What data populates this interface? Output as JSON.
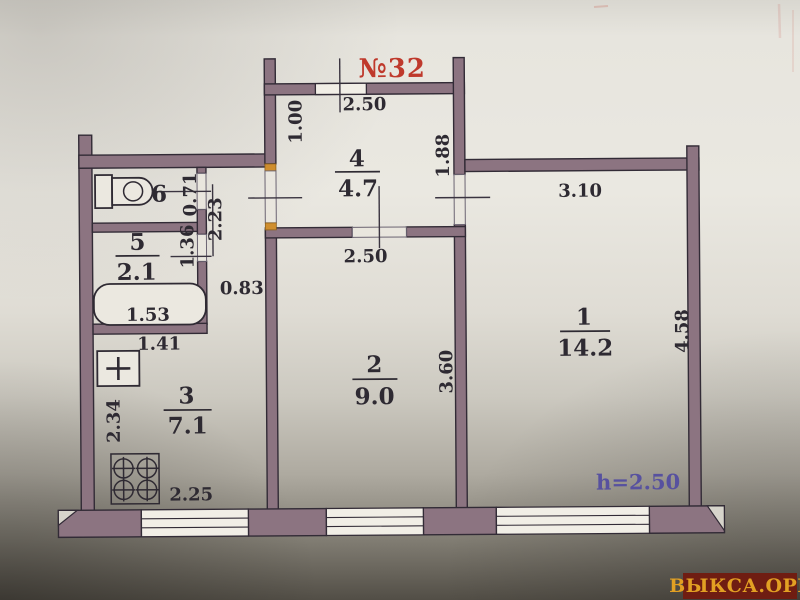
{
  "title": {
    "apartment_no": "№32"
  },
  "note": {
    "ceiling_height": "h=2.50"
  },
  "watermark": {
    "text": "ВЫКСА.ОРГ"
  },
  "rooms": [
    {
      "number": "1",
      "area": "14.2"
    },
    {
      "number": "2",
      "area": "9.0"
    },
    {
      "number": "3",
      "area": "7.1"
    },
    {
      "number": "4",
      "area": "4.7"
    },
    {
      "number": "5",
      "area": "2.1"
    },
    {
      "number": "6",
      "area": ""
    }
  ],
  "dims": {
    "room4_width": "2.50",
    "room4_upper_depth": "1.00",
    "room4_right": "1.88",
    "room1_width": "3.10",
    "room1_depth": "4.58",
    "room2_width": "2.50",
    "room2_depth": "3.60",
    "corridor_width": "0.83",
    "corridor_length": "2.23",
    "wc_door": "0.71",
    "bath_wall": "1.36",
    "bathtub_length": "1.53",
    "kitchen_sink_offset": "1.41",
    "kitchen_depth": "2.34",
    "kitchen_width": "2.25"
  },
  "colors": {
    "wall_fill": "#8c7481",
    "line_dark": "#322b36",
    "accent_red": "#bf392c",
    "height_note": "#57519f",
    "watermark_bg": "#6f1d12",
    "watermark_text": "#e2a023",
    "hinge_orange": "#cf8e2e"
  },
  "fixtures": [
    "toilet-icon",
    "bathtub-icon",
    "sink-icon",
    "stove-icon"
  ]
}
